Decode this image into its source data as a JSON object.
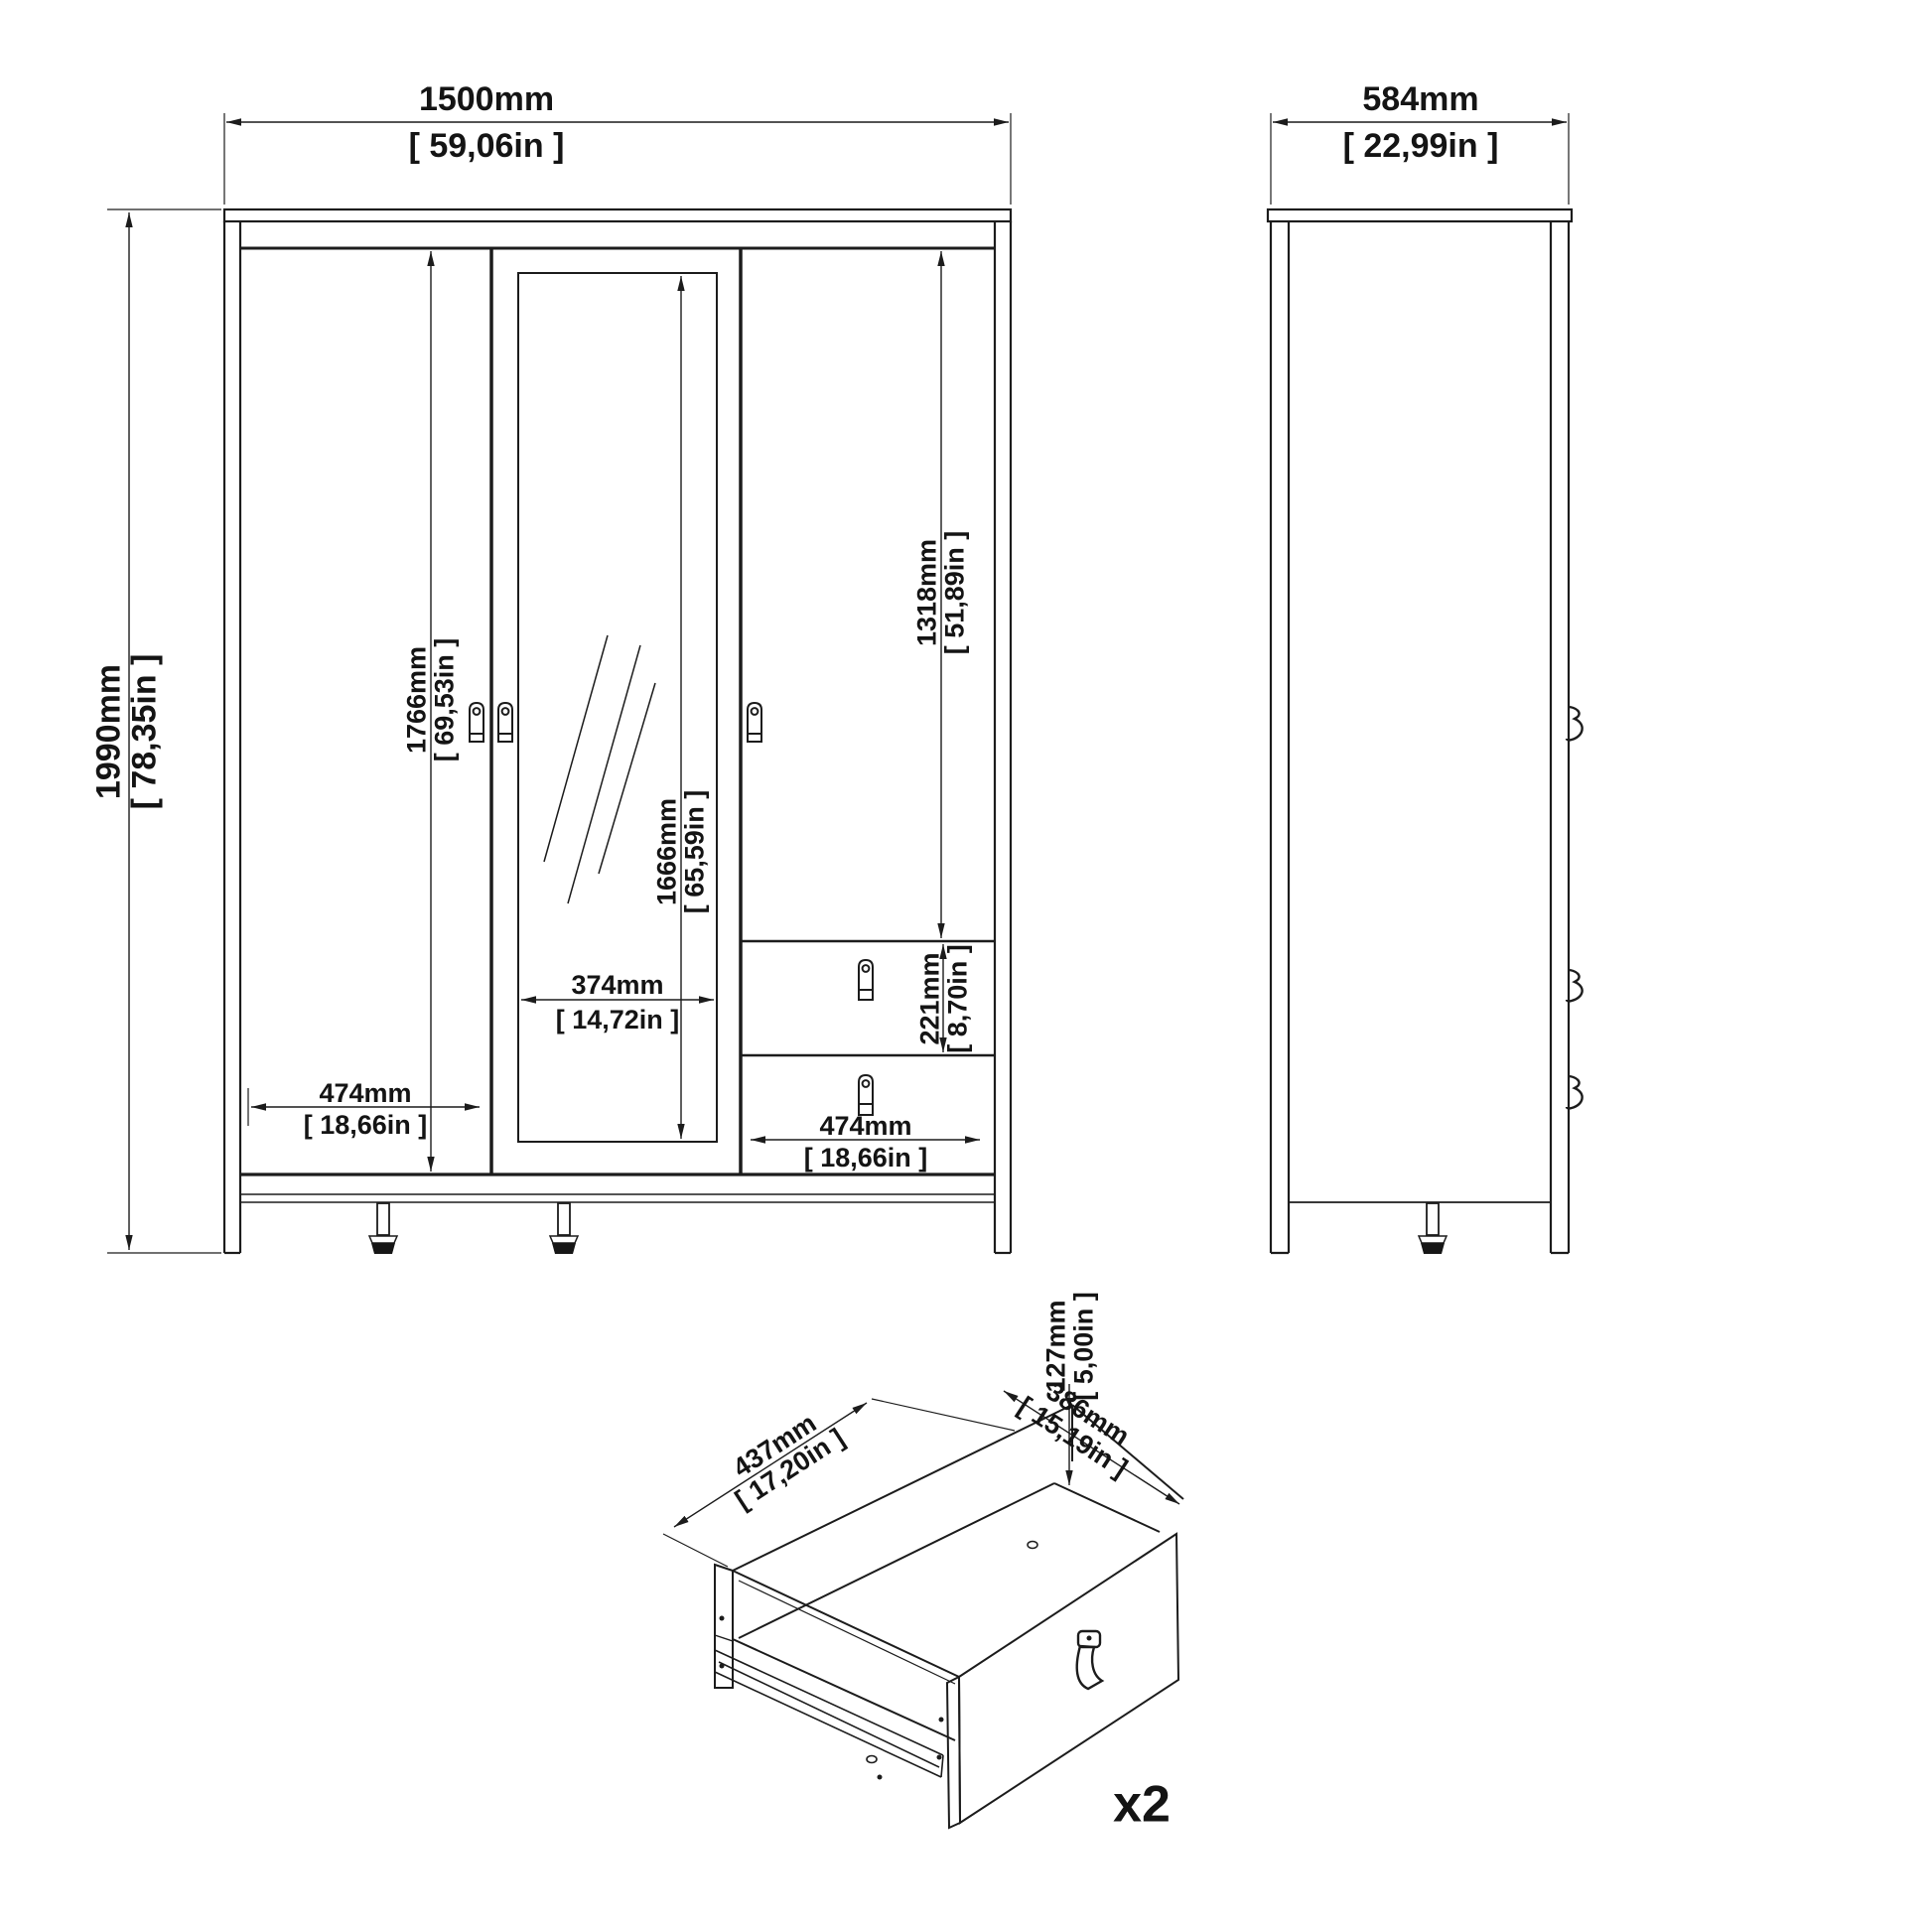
{
  "views": {
    "front": {
      "width": {
        "mm": "1500mm",
        "inch": "[ 59,06in ]"
      },
      "height": {
        "mm": "1990mm",
        "inch": "[ 78,35in ]"
      },
      "door_height": {
        "mm": "1766mm",
        "inch": "[ 69,53in ]"
      },
      "mirror_height": {
        "mm": "1666mm",
        "inch": "[ 65,59in ]"
      },
      "right_door_height": {
        "mm": "1318mm",
        "inch": "[ 51,89in ]"
      },
      "drawer_front_height": {
        "mm": "221mm",
        "inch": "[ 8,70in ]"
      },
      "mirror_width": {
        "mm": "374mm",
        "inch": "[ 14,72in ]"
      },
      "left_door_width": {
        "mm": "474mm",
        "inch": "[ 18,66in ]"
      },
      "right_section_width": {
        "mm": "474mm",
        "inch": "[ 18,66in ]"
      }
    },
    "side": {
      "depth": {
        "mm": "584mm",
        "inch": "[ 22,99in ]"
      }
    },
    "drawer": {
      "inner_height": {
        "mm": "127mm",
        "inch": "[ 5,00in ]"
      },
      "front_width": {
        "mm": "437mm",
        "inch": "[ 17,20in ]"
      },
      "depth": {
        "mm": "386mm",
        "inch": "[ 15,19in ]"
      },
      "quantity_label": "x2"
    }
  },
  "style": {
    "line_color": "#1c1c1c",
    "background": "#ffffff"
  }
}
